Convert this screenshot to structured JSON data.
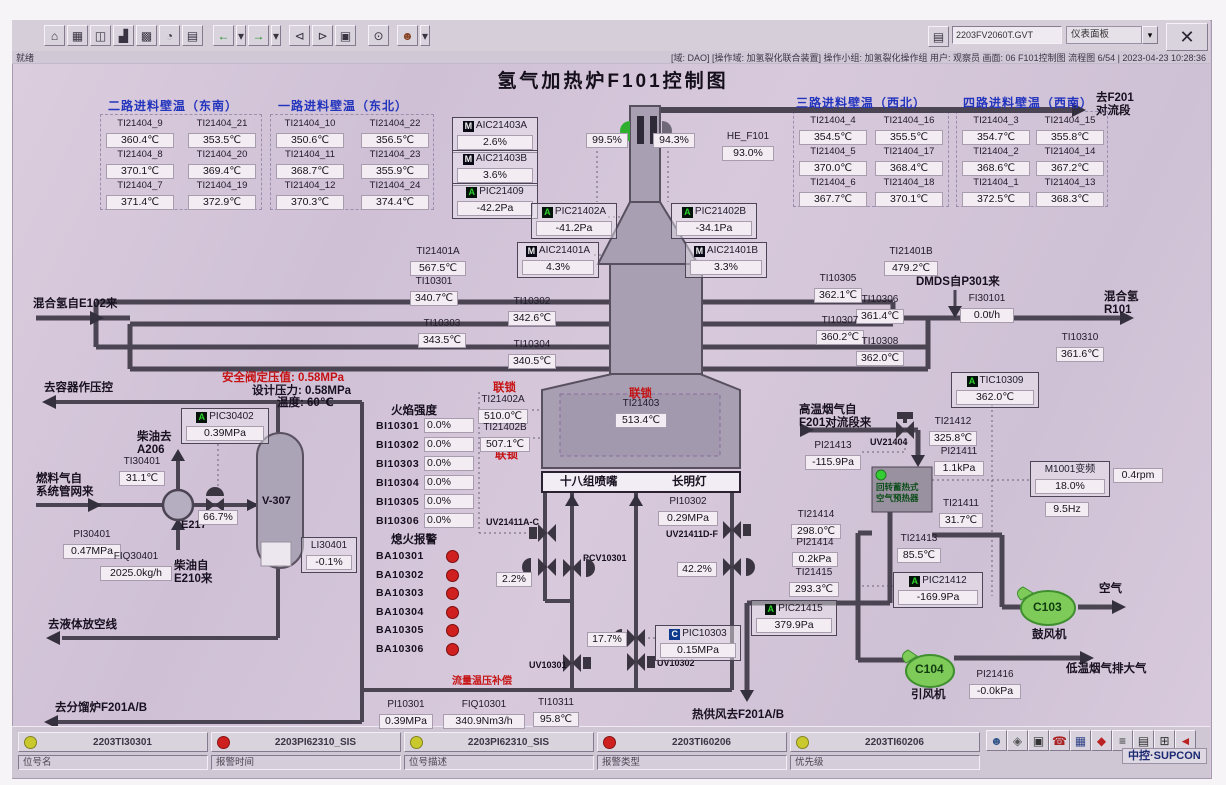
{
  "title": "氢气加热炉F101控制图",
  "statusbar": {
    "ready": "就绪",
    "info": "[域: DAO] [操作域: 加氢裂化联合装置]  操作小组: 加氢裂化操作组  用户: 观察员  画面: 06 F101控制图  流程图 6/54 | 2023-04-23 10:28:36"
  },
  "toolbar": {
    "screen_file": "2203FV2060T.GVT",
    "panel_label": "仪表面板",
    "panel_arrow": "▾",
    "folder_glyph": "▤",
    "close_label": "✕",
    "icons": [
      {
        "g": "⌂",
        "n": "home"
      },
      {
        "g": "▦",
        "n": "overview"
      },
      {
        "g": "◫",
        "n": "window"
      },
      {
        "g": "▟",
        "n": "factory"
      },
      {
        "g": "▩",
        "n": "group-display"
      },
      {
        "g": "◔",
        "n": "tuning"
      },
      {
        "g": "▤",
        "n": "report"
      },
      {
        "gap": 8
      },
      {
        "g": "←",
        "n": "back",
        "c": "#1f8a1f"
      },
      {
        "g": "▾",
        "n": "back-menu",
        "w": 10
      },
      {
        "g": "→",
        "n": "forward",
        "c": "#1f8a1f"
      },
      {
        "g": "▾",
        "n": "forward-menu",
        "w": 10
      },
      {
        "gap": 6
      },
      {
        "g": "⊲",
        "n": "page-prev"
      },
      {
        "g": "⊳",
        "n": "page-next"
      },
      {
        "g": "▣",
        "n": "book"
      },
      {
        "gap": 10
      },
      {
        "g": "⊙",
        "n": "search"
      },
      {
        "gap": 6
      },
      {
        "g": "☻",
        "n": "user",
        "c": "#884422"
      },
      {
        "g": "▾",
        "n": "user-menu",
        "w": 10
      }
    ]
  },
  "wall_tables": [
    {
      "header": "二路进料壁温（东南）",
      "hx": 108,
      "hy": 100,
      "x": 104,
      "y": 118,
      "cols": [
        0,
        82
      ],
      "box": [
        100,
        114,
        160,
        94
      ],
      "rows": [
        [
          [
            "TI21404_9",
            "360.4℃"
          ],
          [
            "TI21404_21",
            "353.5℃"
          ]
        ],
        [
          [
            "TI21404_8",
            "370.1℃"
          ],
          [
            "TI21404_20",
            "369.4℃"
          ]
        ],
        [
          [
            "TI21404_7",
            "371.4℃"
          ],
          [
            "TI21404_19",
            "372.9℃"
          ]
        ]
      ]
    },
    {
      "header": "一路进料壁温（东北）",
      "hx": 278,
      "hy": 100,
      "x": 274,
      "y": 118,
      "cols": [
        0,
        85
      ],
      "box": [
        270,
        114,
        162,
        94
      ],
      "rows": [
        [
          [
            "TI21404_10",
            "350.6℃"
          ],
          [
            "TI21404_22",
            "356.5℃"
          ]
        ],
        [
          [
            "TI21404_11",
            "368.7℃"
          ],
          [
            "TI21404_23",
            "355.9℃"
          ]
        ],
        [
          [
            "TI21404_12",
            "370.3℃"
          ],
          [
            "TI21404_24",
            "374.4℃"
          ]
        ]
      ]
    },
    {
      "header": "三路进料壁温（西北）",
      "hx": 796,
      "hy": 97,
      "x": 797,
      "y": 115,
      "cols": [
        0,
        76
      ],
      "box": [
        793,
        111,
        154,
        94
      ],
      "rows": [
        [
          [
            "TI21404_4",
            "354.5℃"
          ],
          [
            "TI21404_16",
            "355.5℃"
          ]
        ],
        [
          [
            "TI21404_5",
            "370.0℃"
          ],
          [
            "TI21404_17",
            "368.4℃"
          ]
        ],
        [
          [
            "TI21404_6",
            "367.7℃"
          ],
          [
            "TI21404_18",
            "370.1℃"
          ]
        ]
      ]
    },
    {
      "header": "四路进料壁温（西南）",
      "hx": 963,
      "hy": 97,
      "x": 960,
      "y": 115,
      "cols": [
        0,
        74
      ],
      "box": [
        956,
        111,
        150,
        94
      ],
      "rows": [
        [
          [
            "TI21404_3",
            "354.7℃"
          ],
          [
            "TI21404_15",
            "355.8℃"
          ]
        ],
        [
          [
            "TI21404_2",
            "368.6℃"
          ],
          [
            "TI21404_14",
            "367.2℃"
          ]
        ],
        [
          [
            "TI21404_1",
            "372.5℃"
          ],
          [
            "TI21404_13",
            "368.3℃"
          ]
        ]
      ]
    }
  ],
  "labels": [
    {
      "t": "去F201\n对流段",
      "x": 1096,
      "y": 92,
      "c": "zh",
      "n": "to-f201-convection"
    },
    {
      "t": "混合氢自E102来",
      "x": 33,
      "y": 298,
      "c": "zh",
      "n": "mixed-h2-from-e102"
    },
    {
      "t": "混合氢\nR101",
      "x": 1104,
      "y": 291,
      "c": "zh",
      "n": "mixed-h2-to-r101"
    },
    {
      "t": "DMDS自P301来",
      "x": 916,
      "y": 276,
      "c": "zh",
      "n": "dmds-from-p301"
    },
    {
      "t": "去容器作压控",
      "x": 44,
      "y": 382,
      "c": "zh",
      "n": "to-vessel-pressure-control"
    },
    {
      "t": "安全阀定压值: 0.58MPa",
      "x": 222,
      "y": 372,
      "c": "red",
      "n": "safety-valve-set-pressure"
    },
    {
      "t": "设计压力: 0.58MPa",
      "x": 252,
      "y": 385,
      "c": "zh",
      "n": "design-pressure"
    },
    {
      "t": "温度: 60℃",
      "x": 277,
      "y": 397,
      "c": "zh",
      "n": "design-temperature"
    },
    {
      "t": "柴油去\nA206",
      "x": 137,
      "y": 431,
      "c": "zh",
      "n": "diesel-to-a206"
    },
    {
      "t": "燃料气自\n系统管网来",
      "x": 36,
      "y": 473,
      "c": "zh",
      "n": "fuel-gas-from-network"
    },
    {
      "t": "E217",
      "x": 181,
      "y": 519,
      "c": "b",
      "n": "exchanger-e217-label"
    },
    {
      "t": "V-307",
      "x": 262,
      "y": 495,
      "c": "b",
      "n": "vessel-v307-label"
    },
    {
      "t": "柴油自\nE210来",
      "x": 174,
      "y": 560,
      "c": "zh",
      "n": "diesel-from-e210"
    },
    {
      "t": "去液体放空线",
      "x": 48,
      "y": 619,
      "c": "zh",
      "n": "to-liquid-vent"
    },
    {
      "t": "去分馏炉F201A/B",
      "x": 55,
      "y": 702,
      "c": "zh",
      "n": "to-fractionator-f201ab"
    },
    {
      "t": "火焰强度",
      "x": 391,
      "y": 405,
      "c": "zh",
      "n": "flame-intensity-header"
    },
    {
      "t": "熄火报警",
      "x": 391,
      "y": 534,
      "c": "zh",
      "n": "flameout-alarm-header"
    },
    {
      "t": "联锁",
      "x": 493,
      "y": 382,
      "c": "red",
      "n": "interlock-label-1"
    },
    {
      "t": "联锁",
      "x": 495,
      "y": 449,
      "c": "red",
      "n": "interlock-label-2"
    },
    {
      "t": "联锁",
      "x": 629,
      "y": 388,
      "c": "red",
      "n": "interlock-label-3"
    },
    {
      "t": "十八组喷嘴",
      "x": 560,
      "y": 476,
      "c": "zh",
      "n": "burner-groups-label"
    },
    {
      "t": "长明灯",
      "x": 672,
      "y": 476,
      "c": "zh",
      "n": "pilot-lamp-label"
    },
    {
      "t": "流量温压补偿",
      "x": 452,
      "y": 676,
      "c": "redsm",
      "n": "flow-temp-press-compensation"
    },
    {
      "t": "热供风去F201A/B",
      "x": 692,
      "y": 709,
      "c": "zh",
      "n": "hot-air-to-f201ab"
    },
    {
      "t": "高温烟气自\nF201对流段来",
      "x": 799,
      "y": 404,
      "c": "zh",
      "n": "hot-fluegas-from-f201"
    },
    {
      "t": "UV21404",
      "x": 870,
      "y": 437,
      "c": "sm",
      "n": "uv21404-label"
    },
    {
      "t": "UV21411A-C",
      "x": 486,
      "y": 517,
      "c": "sm",
      "n": "uv21411ac-label"
    },
    {
      "t": "UV21411D-F",
      "x": 666,
      "y": 529,
      "c": "sm",
      "n": "uv21411df-label"
    },
    {
      "t": "PCV10301",
      "x": 583,
      "y": 553,
      "c": "sm",
      "n": "pcv10301-label"
    },
    {
      "t": "UV10301",
      "x": 529,
      "y": 660,
      "c": "sm",
      "n": "uv10301-label"
    },
    {
      "t": "UV10302",
      "x": 657,
      "y": 658,
      "c": "sm",
      "n": "uv10302-label"
    },
    {
      "t": "回转蓄热式\n空气预热器",
      "x": 876,
      "y": 482,
      "c": "ph",
      "n": "air-preheater-label"
    },
    {
      "t": "空气",
      "x": 1099,
      "y": 583,
      "c": "zh",
      "n": "air-label"
    },
    {
      "t": "C103",
      "x": 1033,
      "y": 601,
      "c": "fan",
      "n": "fan-c103-label"
    },
    {
      "t": "鼓风机",
      "x": 1032,
      "y": 629,
      "c": "zh",
      "n": "blower-label"
    },
    {
      "t": "C104",
      "x": 915,
      "y": 663,
      "c": "fan",
      "n": "fan-c104-label"
    },
    {
      "t": "引风机",
      "x": 911,
      "y": 689,
      "c": "zh",
      "n": "induced-draft-fan-label"
    },
    {
      "t": "低温烟气排大气",
      "x": 1066,
      "y": 663,
      "c": "zh",
      "n": "cold-fluegas-to-atmosphere"
    }
  ],
  "tags": [
    {
      "p": "M",
      "t": "AIC21403A",
      "v": "2.6%",
      "x": 452,
      "y": 117,
      "w": 80,
      "box": true
    },
    {
      "p": "M",
      "t": "AIC21403B",
      "v": "3.6%",
      "x": 452,
      "y": 150,
      "w": 80,
      "box": true
    },
    {
      "p": "A",
      "t": "PIC21409",
      "v": "-42.2Pa",
      "x": 452,
      "y": 183,
      "w": 80,
      "box": true
    },
    {
      "p": "A",
      "t": "PIC21402A",
      "v": "-41.2Pa",
      "x": 531,
      "y": 203,
      "w": 80,
      "box": true
    },
    {
      "p": "A",
      "t": "PIC21402B",
      "v": "-34.1Pa",
      "x": 671,
      "y": 203,
      "w": 80,
      "box": true
    },
    {
      "p": "M",
      "t": "AIC21401A",
      "v": "4.3%",
      "x": 517,
      "y": 242,
      "w": 76,
      "box": true
    },
    {
      "p": "M",
      "t": "AIC21401B",
      "v": "3.3%",
      "x": 685,
      "y": 242,
      "w": 76,
      "box": true
    },
    {
      "t": "HE_F101",
      "v": "93.0%",
      "x": 720,
      "y": 131,
      "w": 56
    },
    {
      "t": "TI21401A",
      "v": "567.5℃",
      "x": 408,
      "y": 246,
      "w": 60
    },
    {
      "t": "TI10301",
      "v": "340.7℃",
      "x": 408,
      "y": 276,
      "w": 52
    },
    {
      "t": "TI10302",
      "v": "342.6℃",
      "x": 506,
      "y": 296,
      "w": 52
    },
    {
      "t": "TI10303",
      "v": "343.5℃",
      "x": 416,
      "y": 318,
      "w": 52
    },
    {
      "t": "TI10304",
      "v": "340.5℃",
      "x": 506,
      "y": 339,
      "w": 52
    },
    {
      "t": "TI21401B",
      "v": "479.2℃",
      "x": 882,
      "y": 246,
      "w": 58
    },
    {
      "t": "TI10305",
      "v": "362.1℃",
      "x": 812,
      "y": 273,
      "w": 52
    },
    {
      "t": "TI10306",
      "v": "361.4℃",
      "x": 854,
      "y": 294,
      "w": 52
    },
    {
      "t": "TI10307",
      "v": "360.2℃",
      "x": 814,
      "y": 315,
      "w": 52
    },
    {
      "t": "TI10308",
      "v": "362.0℃",
      "x": 854,
      "y": 336,
      "w": 52
    },
    {
      "t": "FI30101",
      "v": "0.0t/h",
      "x": 958,
      "y": 293,
      "w": 58
    },
    {
      "t": "TI10310",
      "v": "361.6℃",
      "x": 1054,
      "y": 332,
      "w": 52
    },
    {
      "p": "A",
      "t": "TIC10309",
      "v": "362.0℃",
      "x": 951,
      "y": 372,
      "w": 82,
      "box": true
    },
    {
      "t": "TI21402A",
      "v": "510.0℃",
      "x": 476,
      "y": 394,
      "w": 54
    },
    {
      "t": "TI21402B",
      "v": "507.1℃",
      "x": 478,
      "y": 422,
      "w": 54
    },
    {
      "t": "TI21403",
      "v": "513.4℃",
      "x": 613,
      "y": 398,
      "w": 56
    },
    {
      "p": "A",
      "t": "PIC30402",
      "v": "0.39MPa",
      "x": 181,
      "y": 408,
      "w": 82,
      "box": true
    },
    {
      "t": "TI30401",
      "v": "31.1℃",
      "x": 117,
      "y": 456,
      "w": 50
    },
    {
      "t": "PI30401",
      "v": "0.47MPa",
      "x": 61,
      "y": 529,
      "w": 62
    },
    {
      "t": "FIQ30401",
      "v": "2025.0kg/h",
      "x": 98,
      "y": 551,
      "w": 76
    },
    {
      "t": "LI30401",
      "v": "-0.1%",
      "x": 301,
      "y": 537,
      "w": 50,
      "box": true
    },
    {
      "t": "PI10302",
      "v": "0.29MPa",
      "x": 656,
      "y": 496,
      "w": 64
    },
    {
      "p": "C",
      "t": "PIC10303",
      "v": "0.15MPa",
      "x": 655,
      "y": 625,
      "w": 80,
      "box": true
    },
    {
      "p": "A",
      "t": "PIC21415",
      "v": "379.9Pa",
      "x": 751,
      "y": 600,
      "w": 80,
      "box": true
    },
    {
      "t": "PI10301",
      "v": "0.39MPa",
      "x": 377,
      "y": 699,
      "w": 58
    },
    {
      "t": "FIQ10301",
      "v": "340.9Nm3/h",
      "x": 441,
      "y": 699,
      "w": 86
    },
    {
      "t": "TI10311",
      "v": "95.8℃",
      "x": 531,
      "y": 697,
      "w": 50
    },
    {
      "t": "TI21412",
      "v": "325.8℃",
      "x": 927,
      "y": 416,
      "w": 52
    },
    {
      "t": "PI21413",
      "v": "-115.9Pa",
      "x": 803,
      "y": 440,
      "w": 60
    },
    {
      "t": "PI21411",
      "v": "1.1kPa",
      "x": 932,
      "y": 446,
      "w": 54
    },
    {
      "t": "TI21411",
      "v": "31.7℃",
      "x": 937,
      "y": 498,
      "w": 48
    },
    {
      "t": "TI21414",
      "v": "298.0℃",
      "x": 789,
      "y": 509,
      "w": 54
    },
    {
      "t": "PI21414",
      "v": "0.2kPa",
      "x": 790,
      "y": 537,
      "w": 50
    },
    {
      "t": "TI21415",
      "v": "293.3℃",
      "x": 787,
      "y": 567,
      "w": 54
    },
    {
      "t": "TI21413",
      "v": "85.5℃",
      "x": 895,
      "y": 533,
      "w": 48
    },
    {
      "p": "A",
      "t": "PIC21412",
      "v": "-169.9Pa",
      "x": 893,
      "y": 572,
      "w": 84,
      "box": true
    },
    {
      "t": "M1001变频",
      "v": "18.0%",
      "x": 1030,
      "y": 461,
      "w": 74,
      "box": true,
      "n": "tag-m1001-vfd"
    },
    {
      "t": "PI21416",
      "v": "-0.0kPa",
      "x": 967,
      "y": 669,
      "w": 56
    },
    {
      "v": "99.5%",
      "x": 584,
      "y": 130,
      "w": 46,
      "n": "stack-damper-a-output"
    },
    {
      "v": "94.3%",
      "x": 651,
      "y": 130,
      "w": 46,
      "n": "stack-damper-b-output"
    },
    {
      "v": "66.7%",
      "x": 196,
      "y": 507,
      "w": 44,
      "n": "fuel-gas-valve-output"
    },
    {
      "v": "2.2%",
      "x": 494,
      "y": 569,
      "w": 40,
      "n": "burner-control-output"
    },
    {
      "v": "42.2%",
      "x": 675,
      "y": 559,
      "w": 44,
      "n": "pilot-control-output"
    },
    {
      "v": "17.7%",
      "x": 585,
      "y": 629,
      "w": 44,
      "n": "pic10303-valve-output"
    },
    {
      "v": "9.5Hz",
      "x": 1043,
      "y": 499,
      "w": 48,
      "n": "m1001-frequency"
    },
    {
      "v": "0.4rpm",
      "x": 1111,
      "y": 465,
      "w": 54,
      "n": "m1001-speed"
    }
  ],
  "flame": {
    "lx": 376,
    "vx": 424,
    "y0": 420,
    "pitch": 19,
    "vw": 44,
    "rows": [
      [
        "BI10301",
        "0.0%"
      ],
      [
        "BI10302",
        "0.0%"
      ],
      [
        "BI10303",
        "0.0%"
      ],
      [
        "BI10304",
        "0.0%"
      ],
      [
        "BI10305",
        "0.0%"
      ],
      [
        "BI10306",
        "0.0%"
      ]
    ]
  },
  "flameout": {
    "lx": 376,
    "dx": 446,
    "y0": 550,
    "pitch": 18.6,
    "dot_color": "#cf1f1f",
    "rows": [
      "BA10301",
      "BA10302",
      "BA10303",
      "BA10304",
      "BA10305",
      "BA10306"
    ]
  },
  "alarm_bar": {
    "x0": 18,
    "cw": 190,
    "gap": 3,
    "cells_y": 732,
    "fields_y": 755,
    "cells": [
      {
        "color": "#c9c92e",
        "tag": "2203TI30301"
      },
      {
        "color": "#cf2020",
        "tag": "2203PI62310_SIS"
      },
      {
        "color": "#c9c92e",
        "tag": "2203PI62310_SIS"
      },
      {
        "color": "#cf2020",
        "tag": "2203TI60206"
      },
      {
        "color": "#c9c92e",
        "tag": "2203TI60206"
      }
    ],
    "fields": [
      "位号名",
      "报警时间",
      "位号描述",
      "报警类型",
      "优先级"
    ]
  },
  "footer": {
    "logo": "中控·SUPCON",
    "icons": [
      {
        "g": "☻",
        "n": "operator",
        "c": "#335588"
      },
      {
        "g": "◈",
        "n": "lock",
        "c": "#555555"
      },
      {
        "g": "▣",
        "n": "monitor",
        "c": "#333333"
      },
      {
        "g": "☎",
        "n": "phone",
        "c": "#aa2222"
      },
      {
        "g": "▦",
        "n": "spreadsheet",
        "c": "#334488"
      },
      {
        "g": "◆",
        "n": "alarm",
        "c": "#bb2222"
      },
      {
        "g": "≡",
        "n": "list",
        "c": "#333333"
      },
      {
        "g": "▤",
        "n": "report",
        "c": "#333333"
      },
      {
        "g": "⊞",
        "n": "network",
        "c": "#333333"
      },
      {
        "g": "◄",
        "n": "horn",
        "c": "#bb2222"
      }
    ]
  }
}
